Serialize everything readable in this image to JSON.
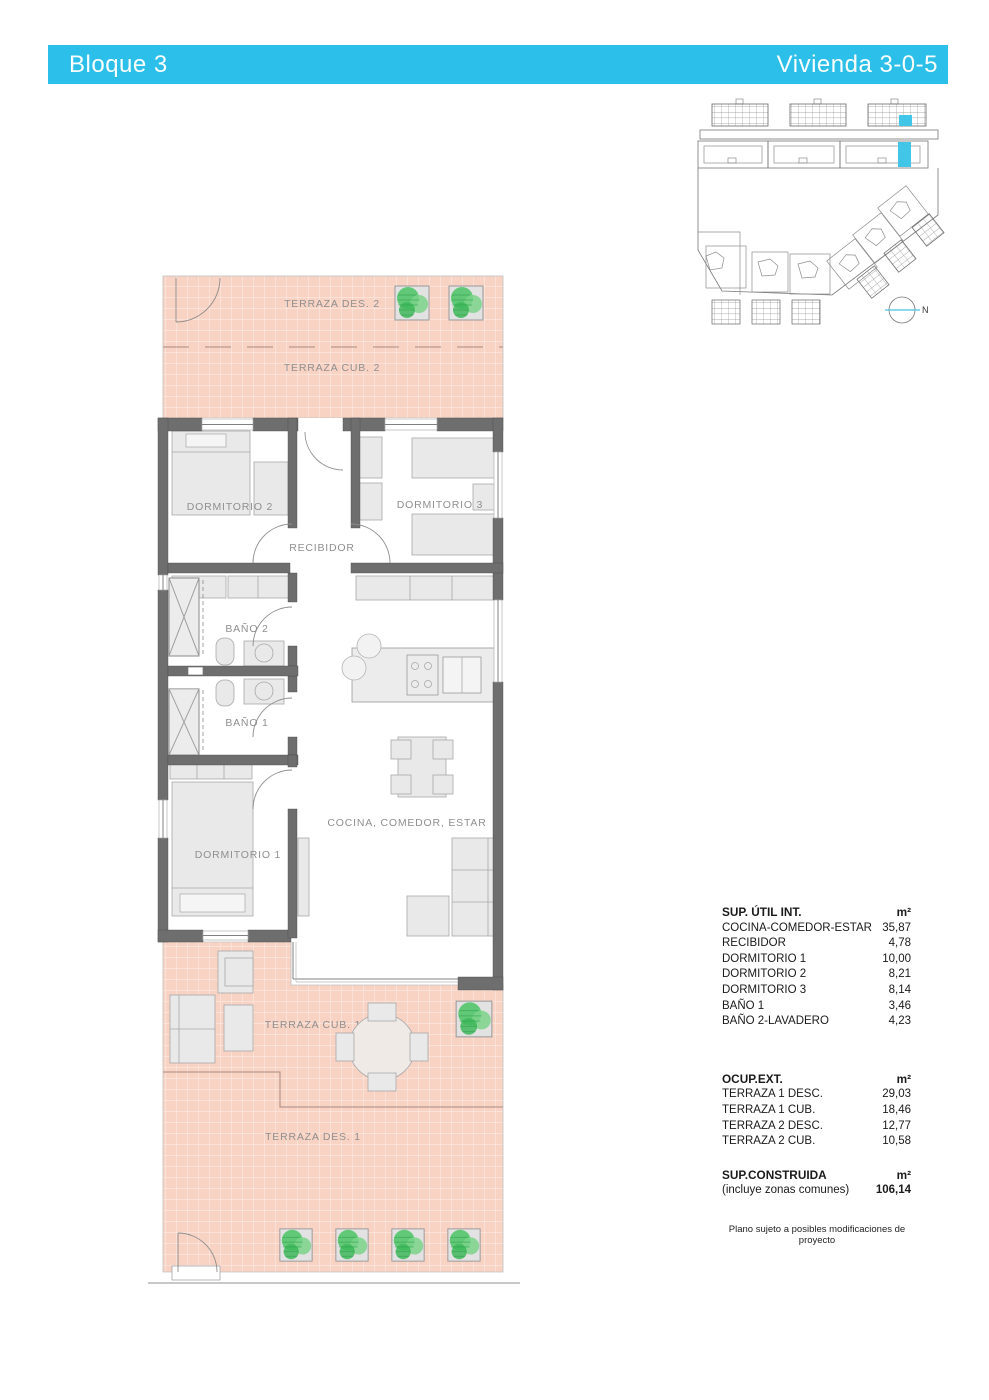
{
  "header": {
    "block_label": "Bloque 3",
    "unit_label": "Vivienda 3-0-5"
  },
  "colors": {
    "accent_cyan": "#2bbfe9",
    "site_highlight": "#41c6e8",
    "terrace_pink": "#f8d2c3",
    "wall_gray": "#6e6e6e",
    "plant_green": "#53c56b"
  },
  "site_plan": {
    "north_label": "N"
  },
  "floor_plan": {
    "labels": {
      "terraza_des_2": "TERRAZA DES. 2",
      "terraza_cub_2": "TERRAZA CUB. 2",
      "dormitorio_2": "DORMITORIO 2",
      "recibidor": "RECIBIDOR",
      "dormitorio_3": "DORMITORIO 3",
      "bano_2": "BAÑO 2",
      "bano_1": "BAÑO 1",
      "dormitorio_1": "DORMITORIO 1",
      "cocina_comedor_estar": "COCINA, COMEDOR, ESTAR",
      "terraza_cub_1": "TERRAZA CUB. 1",
      "terraza_des_1": "TERRAZA DES. 1"
    }
  },
  "areas_table": {
    "sections": [
      {
        "title": "SUP. ÚTIL INT.",
        "unit": "m²",
        "rows": [
          {
            "label": "COCINA-COMEDOR-ESTAR",
            "value": "35,87"
          },
          {
            "label": "RECIBIDOR",
            "value": "4,78"
          },
          {
            "label": "DORMITORIO 1",
            "value": "10,00"
          },
          {
            "label": "DORMITORIO 2",
            "value": "8,21"
          },
          {
            "label": "DORMITORIO 3",
            "value": "8,14"
          },
          {
            "label": "BAÑO 1",
            "value": "3,46"
          },
          {
            "label": "BAÑO 2-LAVADERO",
            "value": "4,23"
          }
        ]
      },
      {
        "title": "OCUP.EXT.",
        "unit": "m²",
        "rows": [
          {
            "label": "TERRAZA 1 DESC.",
            "value": "29,03"
          },
          {
            "label": "TERRAZA 1 CUB.",
            "value": "18,46"
          },
          {
            "label": "TERRAZA 2 DESC.",
            "value": "12,77"
          },
          {
            "label": "TERRAZA 2 CUB.",
            "value": "10,58"
          }
        ]
      },
      {
        "title": "SUP.CONSTRUIDA",
        "unit": "m²",
        "rows": [
          {
            "label": "(incluye zonas comunes)",
            "value": "106,14"
          }
        ]
      }
    ],
    "footnote": "Plano sujeto a posibles modificaciones de proyecto"
  }
}
